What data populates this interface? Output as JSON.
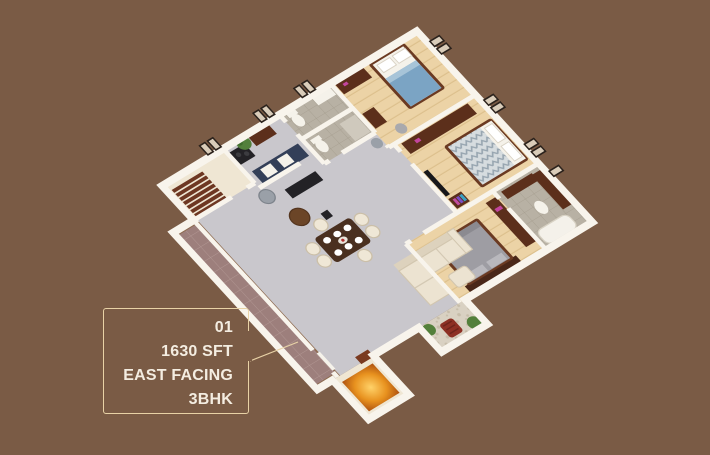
{
  "card": {
    "unit_number": "01",
    "area": "1630 SFT",
    "facing": "EAST FACING",
    "type": "3BHK"
  },
  "theme": {
    "background": "#7a5b45",
    "card_border": "#e8d2a6",
    "card_text": "#f4ede1",
    "wall": "#f8f4ec",
    "floor_living": "#c9c7cc",
    "floor_wood": "#ecd3a6",
    "floor_cream": "#efe6d3",
    "floor_bath": "#b8b1a4",
    "floor_pebble": "#d9d1c2",
    "corridor_tile": "#9d7f7c",
    "corridor_edge": "#8d6a4f",
    "stair_wood": "#6e3722",
    "wood_dark": "#5c2f1b",
    "cabinet_navy": "#333f58",
    "bed_blue": "#7ba4c4",
    "bed_gray": "#9e9da3",
    "sofa_cream": "#ece3d1",
    "dining_wood": "#4a3020",
    "porch_glow_center": "#ffd269",
    "porch_glow_mid": "#e8921f",
    "porch_glow_edge": "#ad500f",
    "plant_green": "#53803b",
    "chair_red": "#8d3024",
    "window_frame": "#2b221c",
    "window_pane": "#d9ccb9",
    "appliance_black": "#232226",
    "fixture_white": "#f5f2ea"
  }
}
